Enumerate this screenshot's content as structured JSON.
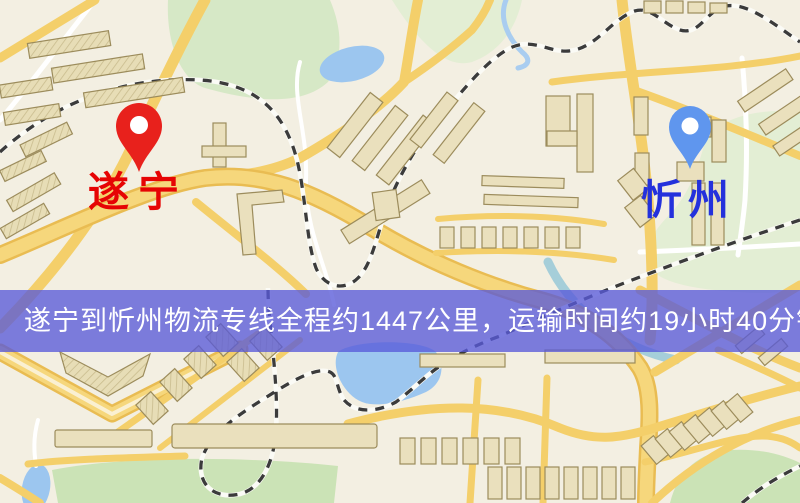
{
  "banner": {
    "text": "遂宁到忻州物流专线全程约1447公里，运输时间约19小时40分钟.",
    "background_color": "#5a5cd8",
    "text_color": "#ffffff"
  },
  "route": {
    "from": "遂宁",
    "to": "忻州",
    "distance_text": "全程约1447公里",
    "duration_text": "运输时间约19小时40分钟"
  },
  "markers": {
    "origin": {
      "label": "遂宁",
      "label_color": "#e60404",
      "pin_icon": "red-map-pin",
      "pin_color": "#e8211c"
    },
    "destination": {
      "label": "忻州",
      "label_color": "#2431dc",
      "pin_icon": "blue-map-pin",
      "pin_color": "#5f96ee"
    }
  },
  "map_colors": {
    "background": "#f3efe2",
    "road_major": "#f4cf6a",
    "road_minor": "#ffffff",
    "park": "#d6e8c6",
    "water": "#9cc6ef",
    "railway": "#3b3b3b",
    "building": "#eae0bd"
  }
}
